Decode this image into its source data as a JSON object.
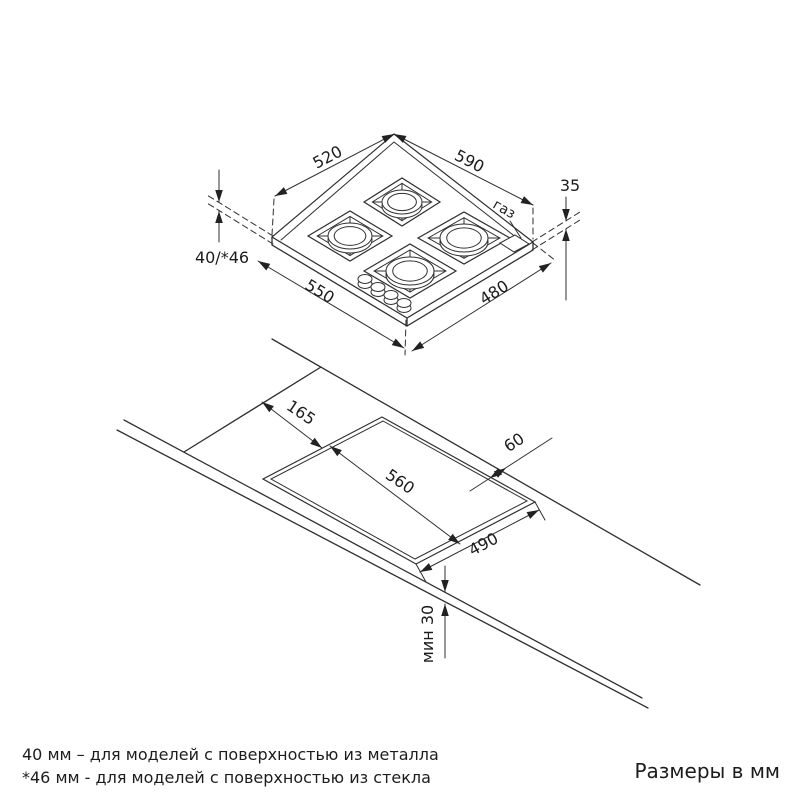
{
  "dims": {
    "w520": "520",
    "d590": "590",
    "t35": "35",
    "gas": "газ",
    "h4046": "40/*46",
    "w550": "550",
    "d480": "480",
    "c165": "165",
    "c560": "560",
    "c60": "60",
    "c490": "490",
    "min30": "мин 30"
  },
  "footer": {
    "note1": "40 мм – для моделей с поверхностью  из металла",
    "note2": "*46 мм - для моделей с поверхностью  из стекла",
    "units": "Размеры в мм"
  }
}
